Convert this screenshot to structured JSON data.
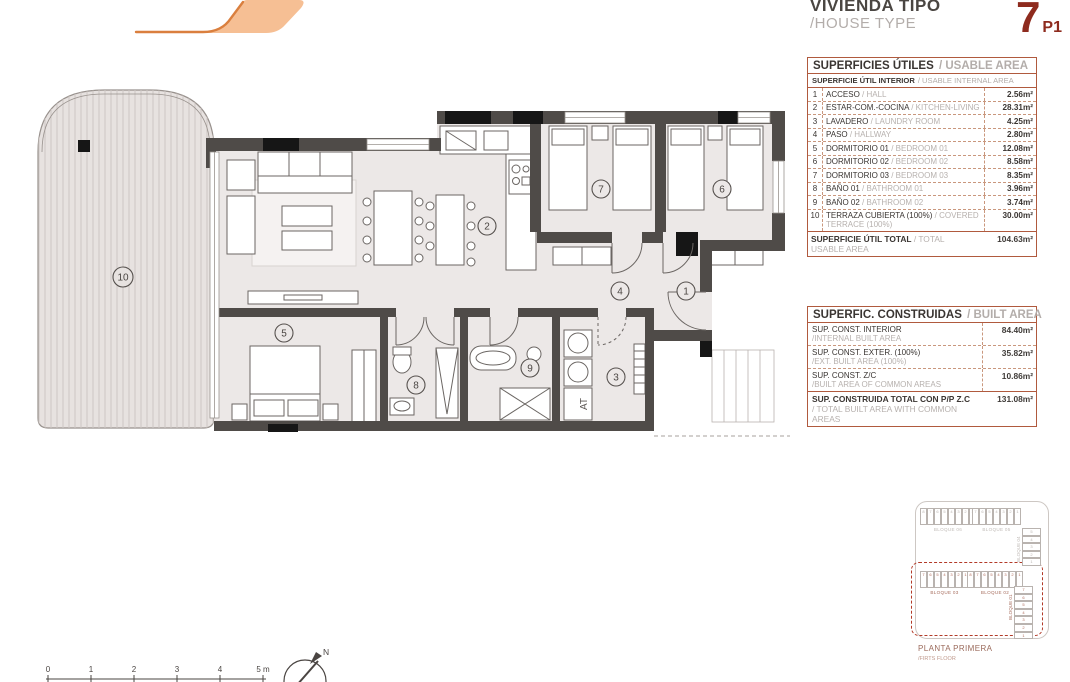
{
  "header": {
    "title_es": "VIVIENDA TIPO",
    "title_en": "/HOUSE TYPE",
    "unit_number": "7",
    "unit_floor": "P1"
  },
  "usable_table": {
    "title_es": "SUPERFICIES ÚTILES",
    "title_en": "/ USABLE AREA",
    "subheader_es": "SUPERFICIE ÚTIL INTERIOR",
    "subheader_en": "/ USABLE INTERNAL AREA",
    "rows": [
      {
        "num": "1",
        "es": "ACCESO",
        "en": " / HALL",
        "value": "2.56m²"
      },
      {
        "num": "2",
        "es": "ESTAR-COM.-COCINA",
        "en": " / KITCHEN-LIVING",
        "value": "28.31m²"
      },
      {
        "num": "3",
        "es": "LAVADERO",
        "en": " / LAUNDRY ROOM",
        "value": "4.25m²"
      },
      {
        "num": "4",
        "es": "PASO",
        "en": " / HALLWAY",
        "value": "2.80m²"
      },
      {
        "num": "5",
        "es": "DORMITORIO 01",
        "en": " / BEDROOM 01",
        "value": "12.08m²"
      },
      {
        "num": "6",
        "es": "DORMITORIO 02",
        "en": " / BEDROOM 02",
        "value": "8.58m²"
      },
      {
        "num": "7",
        "es": "DORMITORIO 03",
        "en": " / BEDROOM 03",
        "value": "8.35m²"
      },
      {
        "num": "8",
        "es": "BAÑO 01",
        "en": " / BATHROOM 01",
        "value": "3.96m²"
      },
      {
        "num": "9",
        "es": "BAÑO 02",
        "en": " / BATHROOM 02",
        "value": "3.74m²"
      },
      {
        "num": "10",
        "es": "TERRAZA CUBIERTA (100%)",
        "en": " / COVERED TERRACE (100%)",
        "value": "30.00m²"
      }
    ],
    "total_es": "SUPERFICIE ÚTIL TOTAL",
    "total_en": " / TOTAL USABLE AREA",
    "total_value": "104.63m²"
  },
  "built_table": {
    "title_es": "SUPERFIC. CONSTRUIDAS",
    "title_en": "/ BUILT AREA",
    "rows": [
      {
        "es": "SUP. CONST. INTERIOR",
        "en": "/INTERNAL BUILT AREA",
        "value": "84.40m²"
      },
      {
        "es": "SUP. CONST. EXTER. (100%)",
        "en": "/EXT. BUILT AREA (100%)",
        "value": "35.82m²"
      },
      {
        "es": "SUP. CONST. Z/C",
        "en": "/BUILT AREA OF COMMON AREAS",
        "value": "10.86m²"
      }
    ],
    "total_es": "SUP. CONSTRUIDA TOTAL CON P/P Z.C",
    "total_en": "/ TOTAL BUILT AREA WITH COMMON AREAS",
    "total_value": "131.08m²"
  },
  "keyplan": {
    "blocks": {
      "b06": {
        "label": "BLOQUE 06",
        "cells": [
          "8",
          "7",
          "6",
          "5",
          "4",
          "3",
          "2",
          "1"
        ]
      },
      "b05": {
        "label": "BLOQUE 05",
        "cells": [
          "7",
          "6",
          "5",
          "4",
          "3",
          "2",
          "1"
        ]
      },
      "b04": {
        "label": "BLOQUE 04",
        "cells": [
          "5",
          "4",
          "3",
          "2",
          "1"
        ]
      },
      "b03": {
        "label": "BLOQUE 03",
        "cells": [
          "7",
          "6",
          "5",
          "4",
          "3",
          "2",
          "1"
        ]
      },
      "b02": {
        "label": "BLOQUE 02",
        "cells": [
          "8",
          "7",
          "6",
          "5",
          "4",
          "3",
          "2",
          "1"
        ]
      },
      "b01": {
        "label": "BLOQUE 01",
        "cells": [
          "7",
          "6",
          "5",
          "4",
          "3",
          "2",
          "1"
        ]
      }
    },
    "caption_es": "PLANTA PRIMERA",
    "caption_en": "/FIRTS FLOOR"
  },
  "plan": {
    "room_markers": [
      "1",
      "2",
      "3",
      "4",
      "5",
      "6",
      "7",
      "8",
      "9",
      "10"
    ],
    "at_label": "AT",
    "north_label": "N",
    "scale_labels": [
      "0",
      "1",
      "2",
      "3",
      "4",
      "5 m"
    ]
  },
  "colors": {
    "accent_red": "#8e2b1e",
    "logo_peach": "#f6bf94",
    "logo_orange": "#da7f3e",
    "table_border": "#b05a3e",
    "keyplan_highlight": "#dd5f2c",
    "wall": "#4f4b48",
    "floor": "#ece8e7"
  }
}
